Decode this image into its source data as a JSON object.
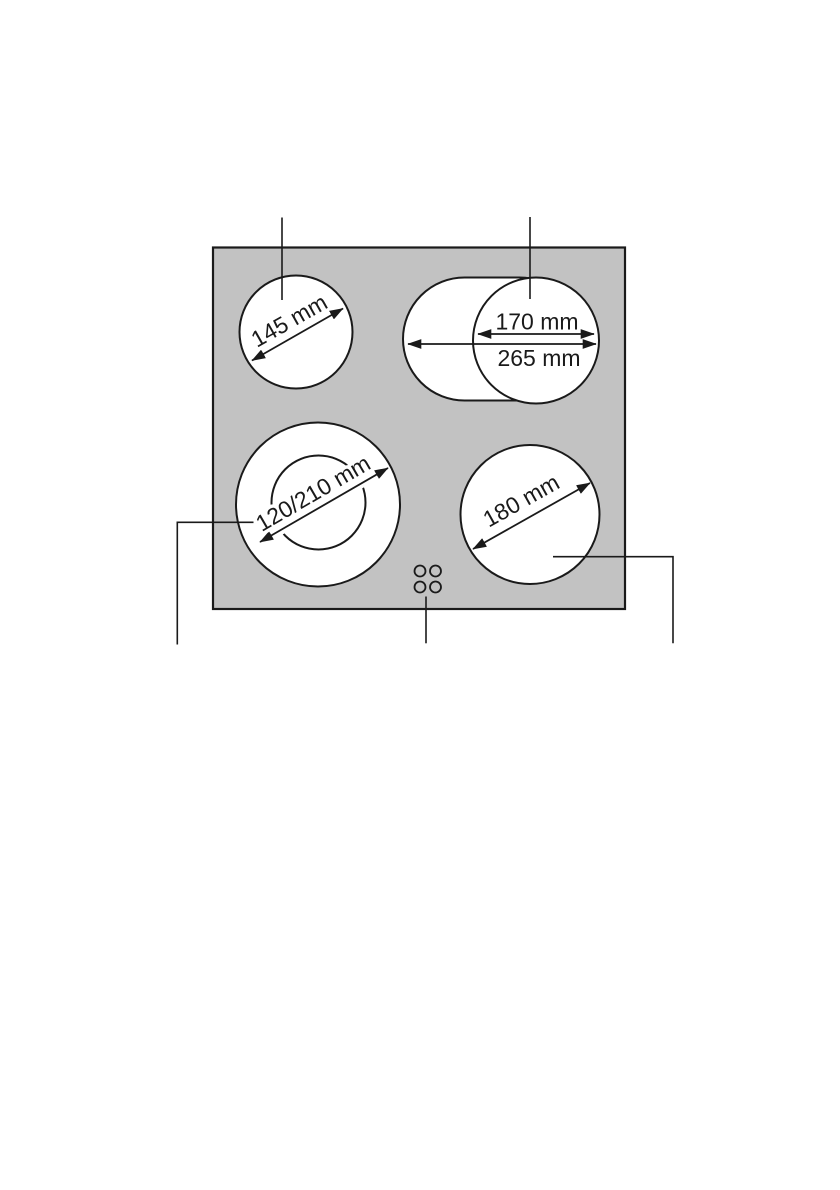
{
  "diagram": {
    "name": "cooktop-cooking-zone-dimensions",
    "colors": {
      "surface": "#c2c2c2",
      "outline": "#1a1a1a",
      "zone_fill": "#ffffff",
      "background": "#ffffff"
    },
    "zones": {
      "back_left": {
        "label": "145 mm"
      },
      "back_right": {
        "inner_label": "170 mm",
        "outer_label": "265 mm"
      },
      "front_left": {
        "label": "120/210 mm"
      },
      "front_right": {
        "label": "180 mm"
      }
    },
    "indicator_dots": {
      "count": 4
    }
  }
}
